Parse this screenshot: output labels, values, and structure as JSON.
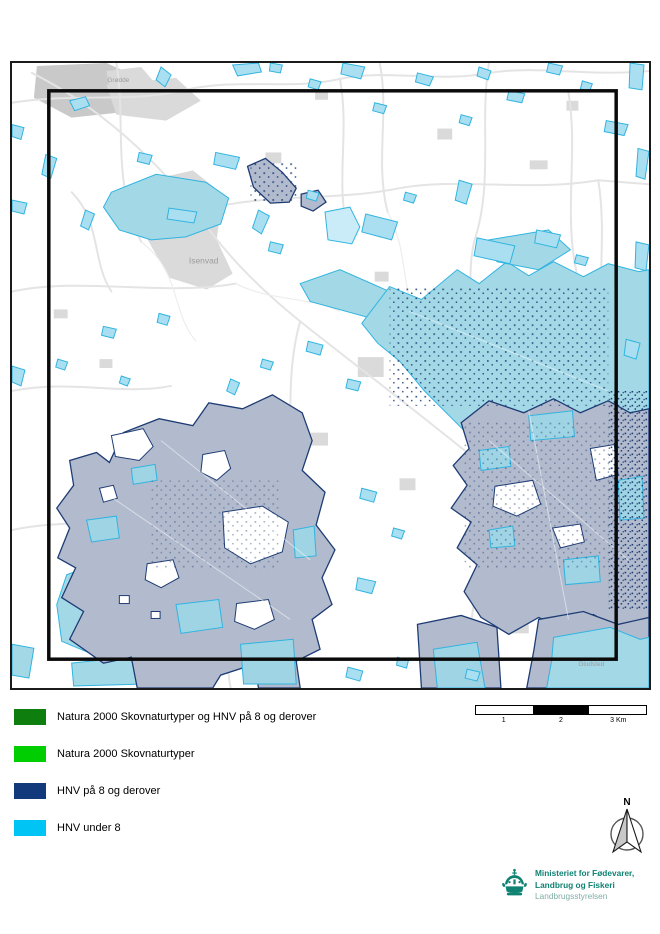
{
  "colors": {
    "map_gray": "#DADADA",
    "map_gray_dark": "#C9C9C9",
    "map_road": "#E4E4E4",
    "map_cyan_fill": "#A9DFF0",
    "map_cyan_big": "#A3D8E6",
    "map_cyan_pale": "#C9ECF8",
    "map_cyan_stroke": "#30B4E0",
    "map_hnv8_fill": "#B2BACD",
    "map_hnv8_stroke": "#1E3C74",
    "label_gray": "#9C9C9C",
    "logo_teal": "#0F8272",
    "logo_teal_light": "#7FAEA3"
  },
  "map": {
    "labels": {
      "town": "Isenvad",
      "village_top": "Grødde",
      "village_bottom": "Gludsted"
    }
  },
  "legend": {
    "items": [
      {
        "label": "Natura 2000 Skovnaturtyper og HNV på 8 og derover",
        "color": "#0E7F0E"
      },
      {
        "label": "Natura 2000 Skovnaturtyper",
        "color": "#00CE00"
      },
      {
        "label": "HNV på 8 og derover",
        "color": "#12397C"
      },
      {
        "label": "HNV under 8",
        "color": "#00C4F4"
      }
    ]
  },
  "scalebar": {
    "ticks": [
      "1",
      "2",
      "3 Km"
    ]
  },
  "north_arrow": {
    "label": "N"
  },
  "logo": {
    "line1": "Ministeriet for Fødevarer,",
    "line2": "Landbrug og Fiskeri",
    "line3": "Landbrugsstyrelsen"
  }
}
